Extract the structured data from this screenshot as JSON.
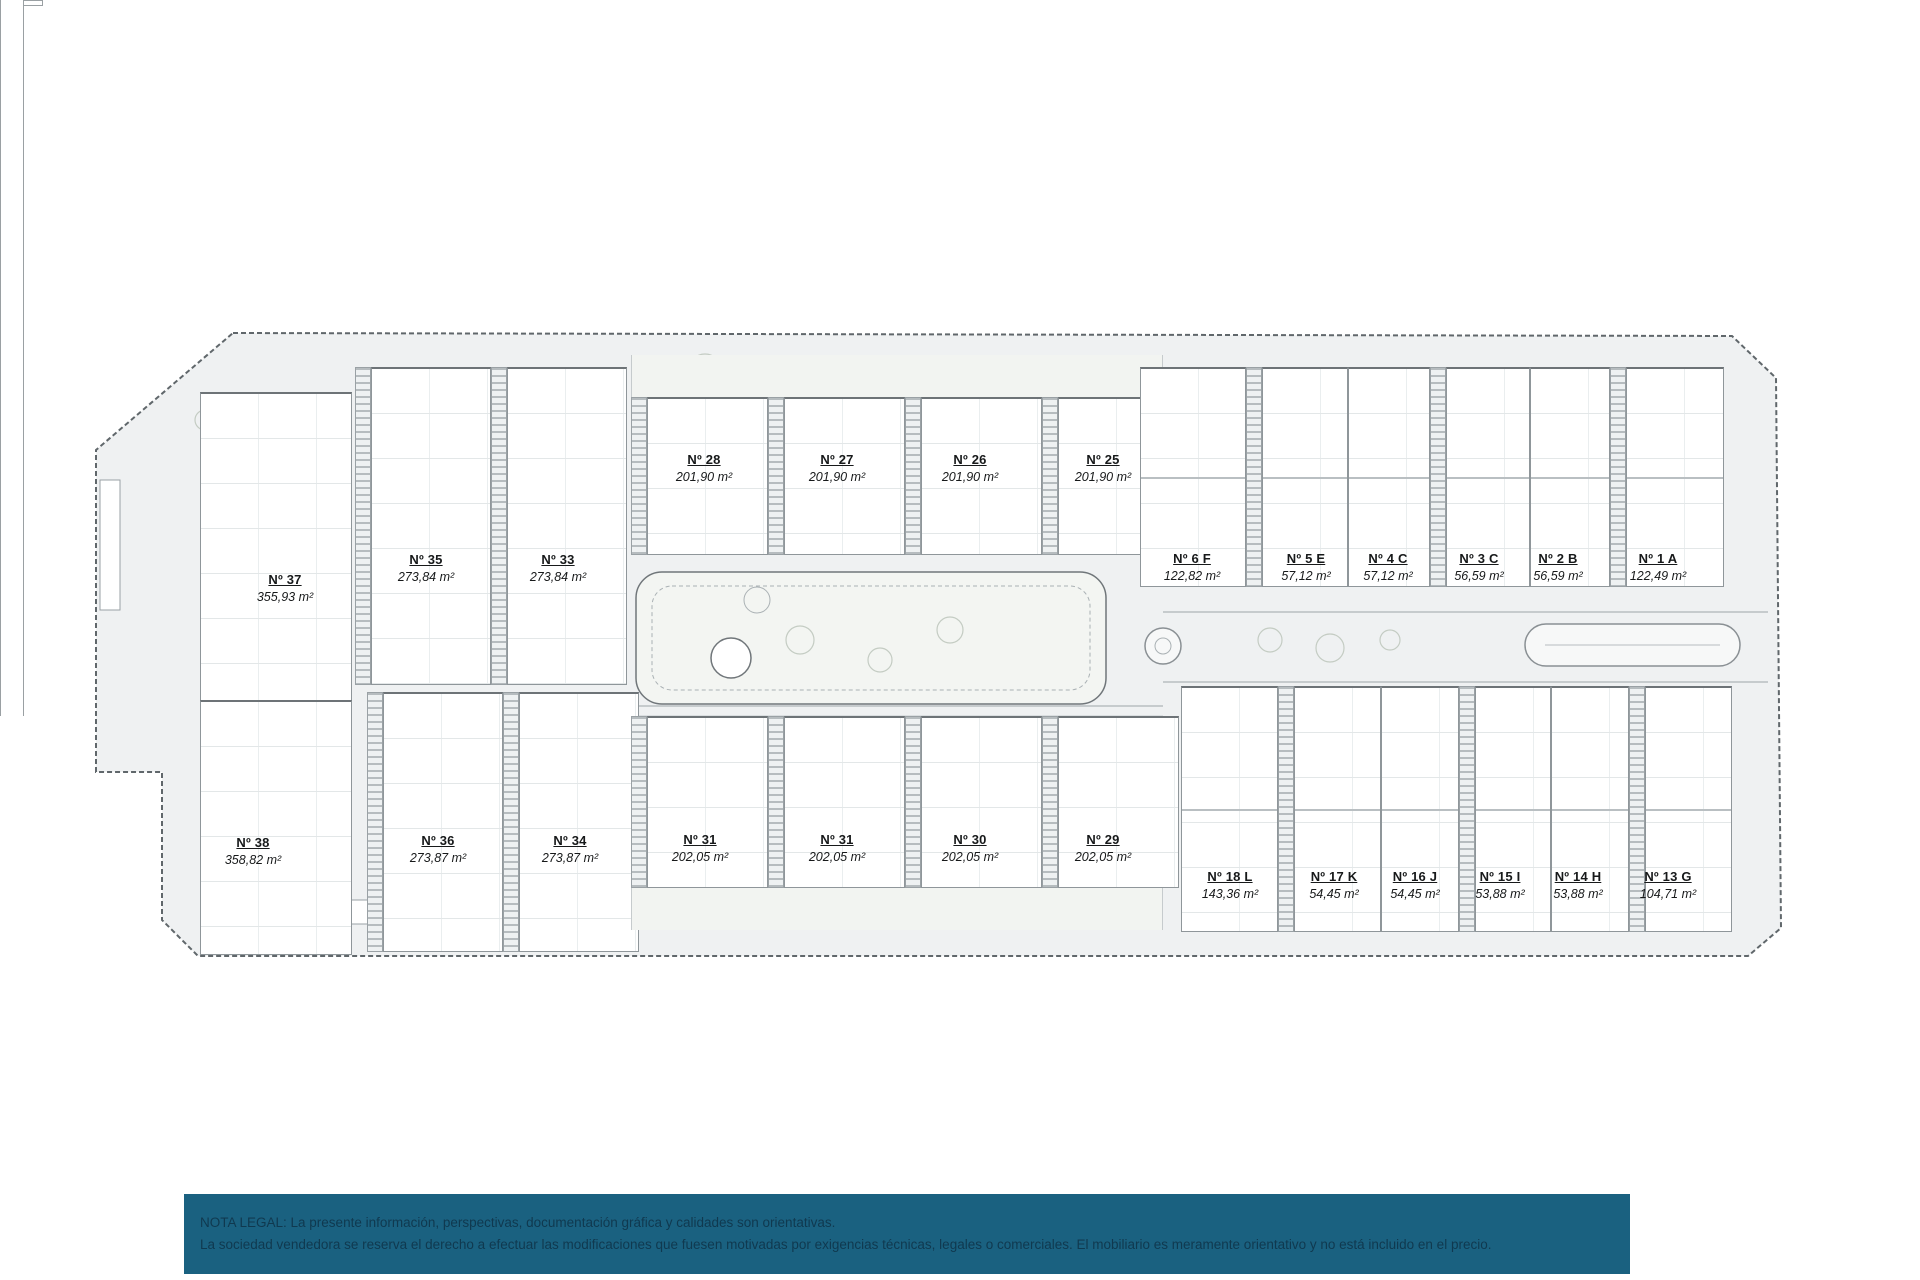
{
  "document": {
    "type": "residential-site-plan",
    "language": "es"
  },
  "units": {
    "villas": [
      {
        "no": "Nº 37",
        "area": "355,93 m²"
      },
      {
        "no": "Nº 38",
        "area": "358,82 m²"
      }
    ],
    "row_upper": [
      {
        "no": "Nº 35",
        "area": "273,84 m²"
      },
      {
        "no": "Nº 33",
        "area": "273,84 m²"
      }
    ],
    "row_lower": [
      {
        "no": "Nº 36",
        "area": "273,87 m²"
      },
      {
        "no": "Nº 34",
        "area": "273,87 m²"
      }
    ],
    "mid_top": [
      {
        "no": "Nº 28",
        "area": "201,90 m²"
      },
      {
        "no": "Nº 27",
        "area": "201,90 m²"
      },
      {
        "no": "Nº 26",
        "area": "201,90 m²"
      },
      {
        "no": "Nº 25",
        "area": "201,90 m²"
      }
    ],
    "mid_bottom": [
      {
        "no": "Nº 31",
        "area": "202,05 m²"
      },
      {
        "no": "Nº 31",
        "area": "202,05 m²"
      },
      {
        "no": "Nº 30",
        "area": "202,05 m²"
      },
      {
        "no": "Nº 29",
        "area": "202,05 m²"
      }
    ],
    "right_top": [
      {
        "no": "Nº 6 F",
        "area": "122,82 m²"
      },
      {
        "no": "Nº 5 E",
        "area": "57,12 m²"
      },
      {
        "no": "Nº 4 C",
        "area": "57,12 m²"
      },
      {
        "no": "Nº 3 C",
        "area": "56,59 m²"
      },
      {
        "no": "Nº 2 B",
        "area": "56,59 m²"
      },
      {
        "no": "Nº 1 A",
        "area": "122,49 m²"
      }
    ],
    "right_bottom": [
      {
        "no": "Nº 18 L",
        "area": "143,36 m²"
      },
      {
        "no": "Nº 17 K",
        "area": "54,45 m²"
      },
      {
        "no": "Nº 16 J",
        "area": "54,45 m²"
      },
      {
        "no": "Nº 15 I",
        "area": "53,88 m²"
      },
      {
        "no": "Nº 14 H",
        "area": "53,88 m²"
      },
      {
        "no": "Nº 13 G",
        "area": "104,71 m²"
      }
    ]
  },
  "legal": {
    "line1": "NOTA LEGAL: La presente información, perspectivas, documentación gráfica y calidades son orientativas.",
    "line2": "La sociedad vendedora se reserva el derecho a efectuar las modificaciones que fuesen motivadas por exigencias técnicas, legales o comerciales. El mobiliario es meramente orientativo y no está incluido en el precio."
  },
  "colors": {
    "footer_bg": "#1a6180",
    "footer_text": "#10394f",
    "site_fill": "#eff1f2",
    "site_outline": "#60676b",
    "building_line": "#8f969a",
    "label_text": "#17191a"
  }
}
